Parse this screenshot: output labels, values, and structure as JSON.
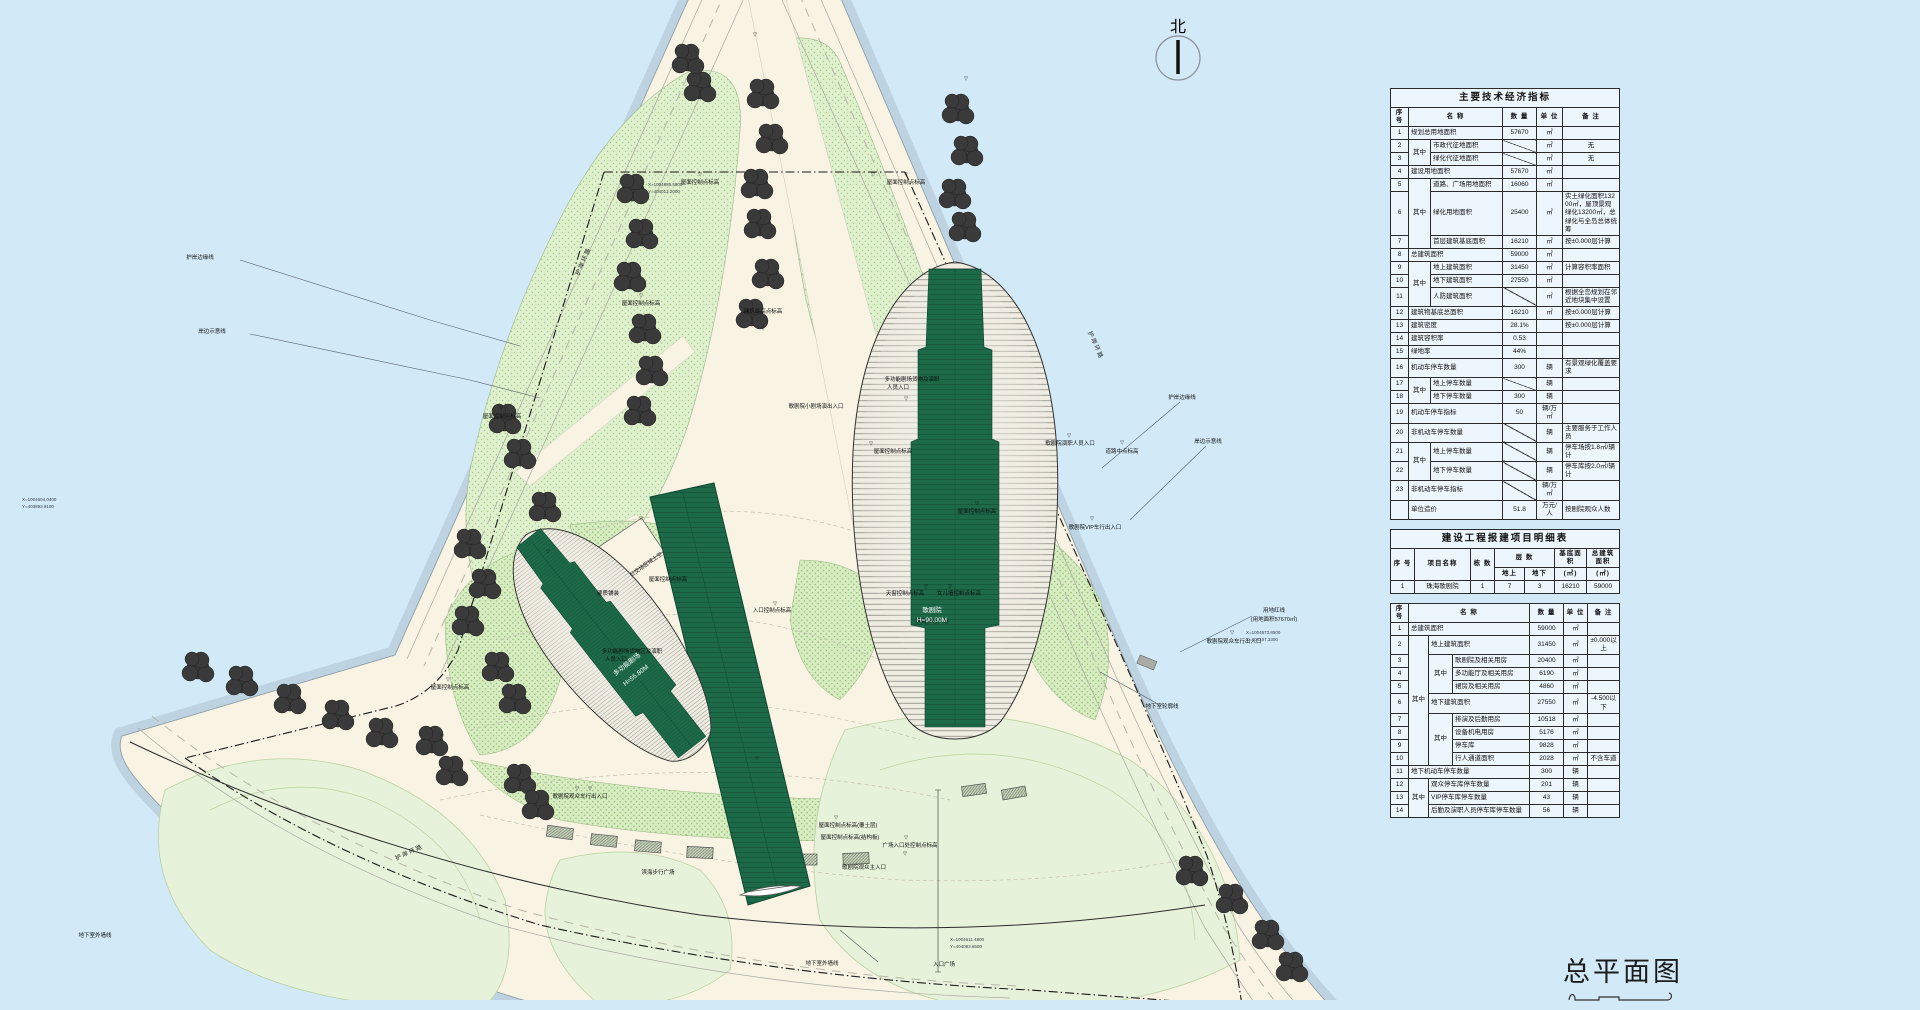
{
  "title_block": {
    "title": "总平面图"
  },
  "north_label": "北",
  "plan": {
    "building_labels": {
      "opera": "歌剧院",
      "opera_height": "H=90.00M",
      "multi_theater": "多功能剧场",
      "multi_theater_height": "H=55.80M"
    },
    "labels": [
      {
        "t": "屋面控制点标高",
        "x": 700,
        "y": 184
      },
      {
        "t": "屋面控制点标高",
        "x": 906,
        "y": 184
      },
      {
        "t": "屋面控制点标高",
        "x": 641,
        "y": 305
      },
      {
        "t": "屋面控制点标高",
        "x": 502,
        "y": 418
      },
      {
        "t": "屋面控制点标高",
        "x": 668,
        "y": 581
      },
      {
        "t": "屋面控制点标高",
        "x": 893,
        "y": 453
      },
      {
        "t": "屋面控制点标高",
        "x": 450,
        "y": 689
      },
      {
        "t": "屋面控制点标高",
        "x": 977,
        "y": 513
      },
      {
        "t": "屋面控制点标高(覆土层)",
        "x": 848,
        "y": 827
      },
      {
        "t": "屋面控制点标高(结构板)",
        "x": 850,
        "y": 839
      },
      {
        "t": "建筑最高点标高",
        "x": 763,
        "y": 313
      },
      {
        "t": "入口控制点标高",
        "x": 772,
        "y": 612
      },
      {
        "t": "歌剧院小剧场演出入口",
        "x": 816,
        "y": 408
      },
      {
        "t": "多功能剧场货物及演职",
        "x": 912,
        "y": 381
      },
      {
        "t": "人员入口",
        "x": 898,
        "y": 389
      },
      {
        "t": "歌剧院观众主入口",
        "x": 864,
        "y": 869
      },
      {
        "t": "广场入口处控制点标高",
        "x": 910,
        "y": 847
      },
      {
        "t": "入口广场",
        "x": 944,
        "y": 966
      },
      {
        "t": "滨海步行广场",
        "x": 658,
        "y": 874
      },
      {
        "t": "滨海步行广场",
        "x": 932,
        "y": 623
      },
      {
        "t": "硬质铺装",
        "x": 608,
        "y": 595
      },
      {
        "t": "公交场区域上空",
        "x": 647,
        "y": 566,
        "r": -35
      },
      {
        "t": "多功能剧场货物区及演职",
        "x": 632,
        "y": 653
      },
      {
        "t": "人员入口",
        "x": 616,
        "y": 661
      },
      {
        "t": "歌剧院观众车行出入口",
        "x": 580,
        "y": 798
      },
      {
        "t": "歌剧院观众车行出入口",
        "x": 1234,
        "y": 643
      },
      {
        "t": "歌剧院VIP车行出入口",
        "x": 1095,
        "y": 529
      },
      {
        "t": "歌剧院演职人员入口",
        "x": 1070,
        "y": 445
      },
      {
        "t": "道路中点标高",
        "x": 1122,
        "y": 453
      },
      {
        "t": "护岸环路",
        "x": 1094,
        "y": 346,
        "r": 66,
        "cls": "r"
      },
      {
        "t": "护岸环路",
        "x": 585,
        "y": 262,
        "r": -66,
        "cls": "r"
      },
      {
        "t": "护岸环路",
        "x": 410,
        "y": 854,
        "r": -25,
        "cls": "r"
      },
      {
        "t": "护岸边缘线",
        "x": 200,
        "y": 259
      },
      {
        "t": "岸边示意线",
        "x": 212,
        "y": 333
      },
      {
        "t": "护岸边缘线",
        "x": 1182,
        "y": 399
      },
      {
        "t": "岸边示意线",
        "x": 1208,
        "y": 443
      },
      {
        "t": "用地红线",
        "x": 1274,
        "y": 612
      },
      {
        "t": "(用地面积57670㎡)",
        "x": 1274,
        "y": 621
      },
      {
        "t": "地下室轮廓线",
        "x": 1162,
        "y": 708
      },
      {
        "t": "地下室外墙线",
        "x": 822,
        "y": 965
      },
      {
        "t": "地下室外墙线",
        "x": 95,
        "y": 937
      },
      {
        "t": "天窗控制点标高",
        "x": 905,
        "y": 595
      },
      {
        "t": "女儿墙控制点标高",
        "x": 959,
        "y": 595
      },
      {
        "t": "歌剧院",
        "x": 932,
        "y": 612,
        "cls": "w"
      },
      {
        "t": "H=90.00M",
        "x": 932,
        "y": 622,
        "cls": "w"
      },
      {
        "t": "多功能剧场",
        "x": 628,
        "y": 666,
        "r": -38,
        "cls": "w"
      },
      {
        "t": "H=55.80M",
        "x": 637,
        "y": 677,
        "r": -38,
        "cls": "w"
      },
      {
        "t": "X=1004885.5800",
        "x": 648,
        "y": 186,
        "cls": "c"
      },
      {
        "t": "Y=404013.2000",
        "x": 648,
        "y": 193,
        "cls": "c"
      },
      {
        "t": "X=1004604.0400",
        "x": 22,
        "y": 501,
        "cls": "c"
      },
      {
        "t": "Y=403893.9100",
        "x": 22,
        "y": 508,
        "cls": "c"
      },
      {
        "t": "X=1004673.8500",
        "x": 1246,
        "y": 634,
        "cls": "c"
      },
      {
        "t": "Y=404187.3300",
        "x": 1246,
        "y": 641,
        "cls": "c"
      },
      {
        "t": "X=1004611.4800",
        "x": 950,
        "y": 941,
        "cls": "c"
      },
      {
        "t": "Y=404083.6500",
        "x": 950,
        "y": 948,
        "cls": "c"
      }
    ],
    "markers": [
      [
        755,
        36
      ],
      [
        966,
        80
      ],
      [
        700,
        176
      ],
      [
        873,
        176
      ],
      [
        906,
        176
      ],
      [
        641,
        297
      ],
      [
        763,
        330
      ],
      [
        501,
        410
      ],
      [
        871,
        445
      ],
      [
        906,
        400
      ],
      [
        641,
        520
      ],
      [
        669,
        573
      ],
      [
        548,
        553
      ],
      [
        448,
        681
      ],
      [
        775,
        605
      ],
      [
        836,
        819
      ],
      [
        906,
        839
      ],
      [
        977,
        505
      ],
      [
        1069,
        437
      ],
      [
        1122,
        444
      ],
      [
        590,
        790
      ],
      [
        757,
        760
      ],
      [
        905,
        855
      ],
      [
        1232,
        634
      ],
      [
        577,
        790
      ],
      [
        1092,
        520
      ],
      [
        442,
        738
      ],
      [
        926,
        588
      ],
      [
        950,
        588
      ]
    ]
  },
  "tables": {
    "t1": {
      "title": "主要技术经济指标",
      "widths": [
        18,
        22,
        72,
        34,
        26,
        57
      ],
      "head": [
        [
          "序 号",
          {
            "t": "名      称",
            "cs": 2
          },
          "数 量",
          "单 位",
          "备  注"
        ]
      ],
      "rows": [
        [
          "1",
          {
            "t": "规划总用地面积",
            "cs": 2,
            "al": 1
          },
          "57670",
          "㎡",
          ""
        ],
        [
          "2",
          {
            "t": "其中",
            "rs": 2
          },
          {
            "t": "市政代征地面积",
            "al": 1
          },
          {
            "sl": 1
          },
          "㎡",
          "无"
        ],
        [
          "3",
          {
            "t": "绿化代征地面积",
            "al": 1
          },
          {
            "sl": 1
          },
          "㎡",
          "无"
        ],
        [
          "4",
          {
            "t": "建设用地面积",
            "cs": 2,
            "al": 1
          },
          "57670",
          "㎡",
          ""
        ],
        [
          "5",
          {
            "t": "其中",
            "rs": 3
          },
          {
            "t": "道路、广场用地面积",
            "al": 1
          },
          "16060",
          "㎡",
          ""
        ],
        [
          "6",
          {
            "t": "绿化用地面积",
            "al": 1
          },
          "25400",
          "㎡",
          {
            "t": "实土绿化面积13200㎡，屋顶景观绿化13200㎡，总绿化与全岛总体统筹",
            "al": 1
          }
        ],
        [
          "7",
          {
            "t": "首层建筑基底面积",
            "al": 1
          },
          "16210",
          "㎡",
          {
            "t": "按±0.000层计算",
            "al": 1
          }
        ],
        [
          "8",
          {
            "t": "总建筑面积",
            "cs": 2,
            "al": 1
          },
          "59000",
          "㎡",
          ""
        ],
        [
          "9",
          {
            "t": "其中",
            "rs": 3
          },
          {
            "t": "地上建筑面积",
            "al": 1
          },
          "31450",
          "㎡",
          {
            "t": "计算容积率面积",
            "al": 1
          }
        ],
        [
          "10",
          {
            "t": "地下建筑面积",
            "al": 1
          },
          "27550",
          "㎡",
          ""
        ],
        [
          "11",
          {
            "t": "人防建筑面积",
            "al": 1
          },
          {
            "sl": 1
          },
          "㎡",
          {
            "t": "根据全岛规划在邻近地块集中设置",
            "al": 1
          }
        ],
        [
          "12",
          {
            "t": "建筑物基底总面积",
            "cs": 2,
            "al": 1
          },
          "16210",
          "㎡",
          {
            "t": "按±0.000层计算",
            "al": 1
          }
        ],
        [
          "13",
          {
            "t": "建筑密度",
            "cs": 2,
            "al": 1
          },
          "28.1%",
          "",
          {
            "t": "按±0.000层计算",
            "al": 1
          }
        ],
        [
          "14",
          {
            "t": "建筑容积率",
            "cs": 2,
            "al": 1
          },
          "0.53",
          "",
          ""
        ],
        [
          "15",
          {
            "t": "绿地率",
            "cs": 2,
            "al": 1
          },
          "44%",
          "",
          ""
        ],
        [
          "16",
          {
            "t": "机动车停车数量",
            "cs": 2,
            "al": 1
          },
          "300",
          "辆",
          {
            "t": "有景观绿化覆盖要求",
            "al": 1
          }
        ],
        [
          "17",
          {
            "t": "其中",
            "rs": 2
          },
          {
            "t": "地上停车数量",
            "al": 1
          },
          {
            "sl": 1
          },
          "辆",
          ""
        ],
        [
          "18",
          {
            "t": "地下停车数量",
            "al": 1
          },
          "300",
          "辆",
          ""
        ],
        [
          "19",
          {
            "t": "机动车停车指标",
            "cs": 2,
            "al": 1
          },
          "50",
          "辆/万㎡",
          ""
        ],
        [
          "20",
          {
            "t": "非机动车停车数量",
            "cs": 2,
            "al": 1
          },
          {
            "sl": 1
          },
          "辆",
          {
            "t": "主要服务于工作人员",
            "al": 1
          }
        ],
        [
          "21",
          {
            "t": "其中",
            "rs": 2
          },
          {
            "t": "地上停车数量",
            "al": 1
          },
          {
            "sl": 1
          },
          "辆",
          {
            "t": "停车场按1.8㎡/辆计",
            "al": 1
          }
        ],
        [
          "22",
          {
            "t": "地下停车数量",
            "al": 1
          },
          {
            "sl": 1
          },
          "辆",
          {
            "t": "停车库按2.0㎡/辆计",
            "al": 1
          }
        ],
        [
          "23",
          {
            "t": "非机动车停车指标",
            "cs": 2,
            "al": 1
          },
          {
            "sl": 1
          },
          "辆/万㎡",
          ""
        ],
        [
          "",
          {
            "t": "单位造价",
            "cs": 2,
            "al": 1
          },
          "51.8",
          "万元/人",
          {
            "t": "按剧院观众人数",
            "al": 1
          }
        ]
      ]
    },
    "t2": {
      "title": "建设工程报建项目明细表",
      "widths": [
        24,
        56,
        24,
        30,
        30,
        32,
        33
      ],
      "head": [
        [
          {
            "t": "序 号",
            "rs": 2
          },
          {
            "t": "项目名称",
            "rs": 2
          },
          {
            "t": "栋 数",
            "rs": 2
          },
          {
            "t": "层  数",
            "cs": 2
          },
          "基底面积",
          "总建筑面积"
        ],
        [
          "地上",
          "地下",
          "(㎡)",
          "(㎡)"
        ]
      ],
      "rows": [
        [
          "1",
          "珠海歌剧院",
          "1",
          "7",
          "3",
          "16210",
          "59000"
        ]
      ]
    },
    "t3": {
      "title": "",
      "widths": [
        18,
        20,
        24,
        77,
        34,
        24,
        32
      ],
      "head": [
        [
          "序 号",
          {
            "t": "名      称",
            "cs": 3
          },
          "数 量",
          "单 位",
          "备 注"
        ]
      ],
      "rows": [
        [
          "1",
          {
            "t": "总建筑面积",
            "cs": 3,
            "al": 1
          },
          "59000",
          "㎡",
          ""
        ],
        [
          "2",
          {
            "t": "其中",
            "rs": 9
          },
          {
            "t": "地上建筑面积",
            "cs": 2,
            "al": 1
          },
          "31450",
          "㎡",
          "±0.000以上"
        ],
        [
          "3",
          {
            "t": "其中",
            "rs": 3
          },
          {
            "t": "歌剧院及相关用房",
            "al": 1
          },
          "20400",
          "㎡",
          ""
        ],
        [
          "4",
          {
            "t": "多功能厅及相关用房",
            "al": 1
          },
          "6190",
          "㎡",
          ""
        ],
        [
          "5",
          {
            "t": "裙房及相关用房",
            "al": 1
          },
          "4860",
          "㎡",
          ""
        ],
        [
          "6",
          {
            "t": "地下建筑面积",
            "cs": 2,
            "al": 1
          },
          "27550",
          "㎡",
          "-4.500以下"
        ],
        [
          "7",
          {
            "t": "其中",
            "rs": 4
          },
          {
            "t": "排演及后勤用房",
            "al": 1
          },
          "10518",
          "㎡",
          ""
        ],
        [
          "8",
          {
            "t": "设备机电用房",
            "al": 1
          },
          "5176",
          "㎡",
          ""
        ],
        [
          "9",
          {
            "t": "停车库",
            "al": 1
          },
          "9828",
          "㎡",
          ""
        ],
        [
          "10",
          {
            "t": "行人通道面积",
            "al": 1
          },
          "2028",
          "㎡",
          "不含车道"
        ],
        [
          "11",
          {
            "t": "地下机动车停车数量",
            "cs": 3,
            "al": 1
          },
          "300",
          "辆",
          ""
        ],
        [
          "12",
          {
            "t": "其中",
            "rs": 3
          },
          {
            "t": "观众停车库停车数量",
            "cs": 2,
            "al": 1
          },
          "201",
          "辆",
          ""
        ],
        [
          "13",
          {
            "t": "VIP停车库停车数量",
            "cs": 2,
            "al": 1
          },
          "43",
          "辆",
          ""
        ],
        [
          "14",
          {
            "t": "后勤及演职人员停车库停车数量",
            "cs": 2,
            "al": 1
          },
          "56",
          "辆",
          ""
        ]
      ]
    }
  },
  "colors": {
    "water": "#d2e9f8",
    "land": "#f8f3e3",
    "green_dotted": "#dff0cd",
    "green_dense": "#d7ecc0",
    "lawn": "#e6f2d9",
    "shell_green": "#1d6a49",
    "tree": "#3a3a3a",
    "boundary": "#1a1a1a"
  }
}
